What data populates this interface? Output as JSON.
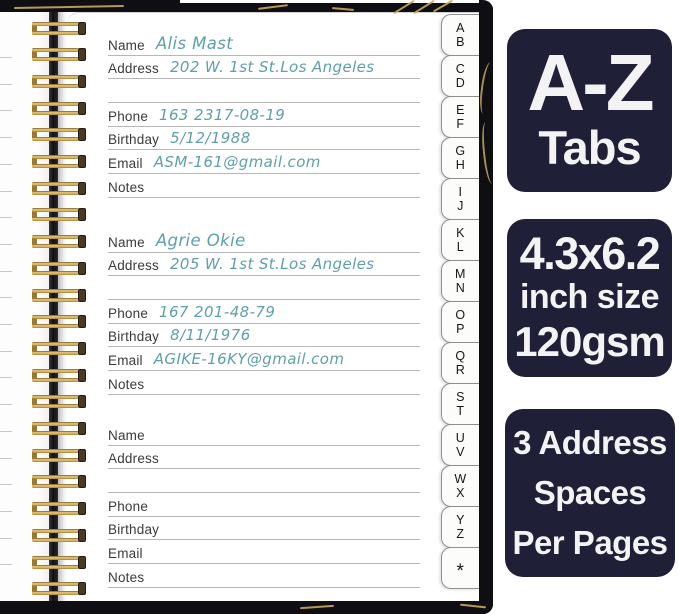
{
  "product": {
    "page": {
      "labels": {
        "name": "Name",
        "address": "Address",
        "phone": "Phone",
        "birthday": "Birthday",
        "email": "Email",
        "notes": "Notes"
      },
      "entries": [
        {
          "name": "Alis Mast",
          "address": "202 W. 1st St.Los Angeles",
          "phone": "163 2317-08-19",
          "birthday": "5/12/1988",
          "email": "ASM-161@gmail.com",
          "notes": ""
        },
        {
          "name": "Agrie Okie",
          "address": "205 W. 1st St.Los Angeles",
          "phone": "167 201-48-79",
          "birthday": "8/11/1976",
          "email": "AGIKE-16KY@gmail.com",
          "notes": ""
        },
        {
          "name": "",
          "address": "",
          "phone": "",
          "birthday": "",
          "email": "",
          "notes": ""
        }
      ]
    },
    "tabs": [
      "A\nB",
      "C\nD",
      "E\nF",
      "G\nH",
      "I\nJ",
      "K\nL",
      "M\nN",
      "O\nP",
      "Q\nR",
      "S\nT",
      "U\nV",
      "W\nX",
      "Y\nZ",
      "*"
    ],
    "badges": [
      {
        "lines": [
          "A-Z",
          "Tabs"
        ]
      },
      {
        "lines": [
          "4.3x6.2",
          "inch size",
          "120gsm"
        ]
      },
      {
        "lines": [
          "3 Address",
          "Spaces",
          "Per Pages"
        ]
      }
    ],
    "colors": {
      "badge_background": "#1f1f37",
      "cover_black": "#0e0e13",
      "handwriting_ink": "#5e9fae",
      "spiral_gold": "#d2a249",
      "gold_vein": "#c9a95c"
    }
  }
}
